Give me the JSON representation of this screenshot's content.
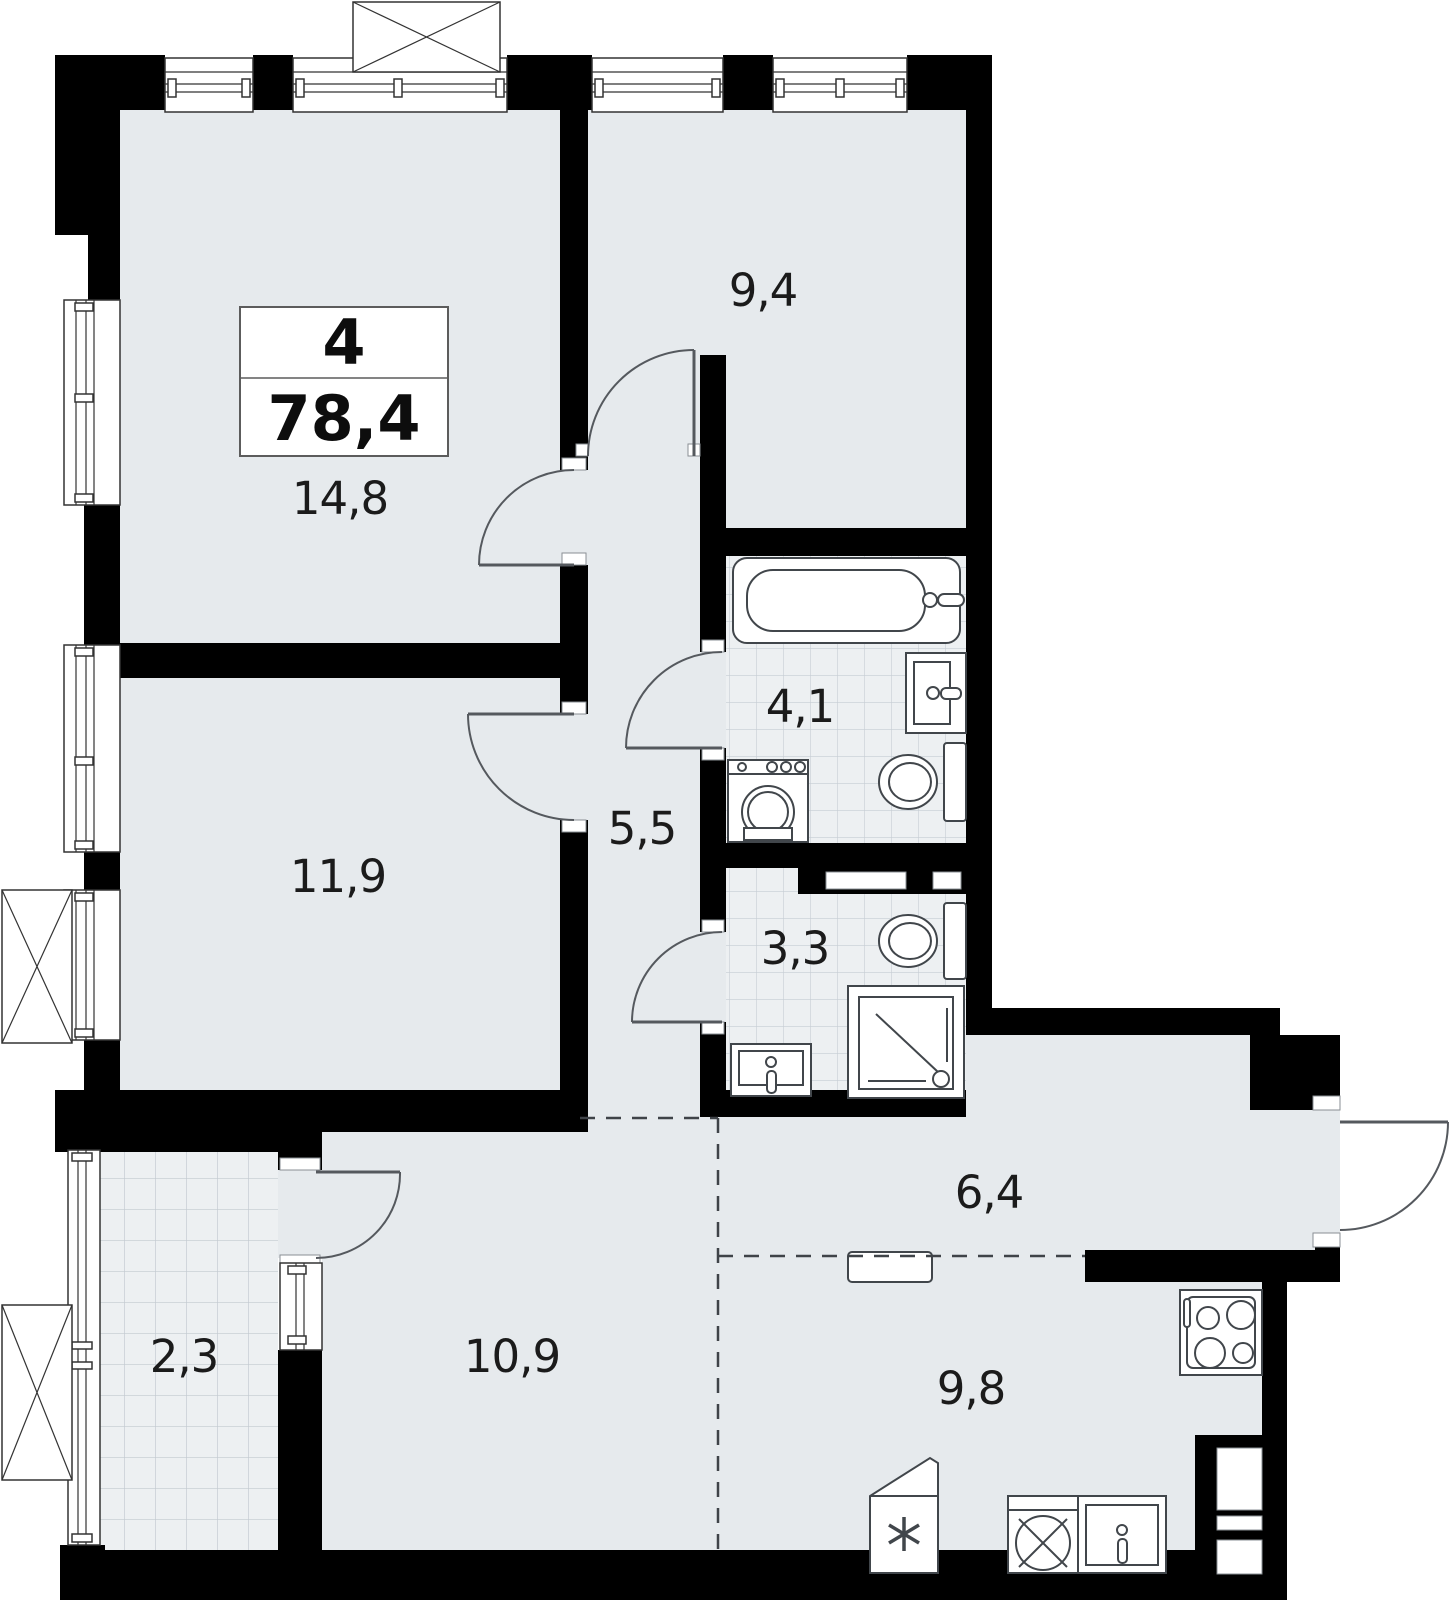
{
  "plan": {
    "summary": {
      "rooms_count": "4",
      "total_area": "78,4"
    },
    "rooms": [
      {
        "key": "room-14-8",
        "label": "14,8"
      },
      {
        "key": "room-9-4",
        "label": "9,4"
      },
      {
        "key": "room-11-9",
        "label": "11,9"
      },
      {
        "key": "hall-5-5",
        "label": "5,5"
      },
      {
        "key": "bath-4-1",
        "label": "4,1"
      },
      {
        "key": "wc-3-3",
        "label": "3,3"
      },
      {
        "key": "corridor-6-4",
        "label": "6,4"
      },
      {
        "key": "balcony-2-3",
        "label": "2,3"
      },
      {
        "key": "living-10-9",
        "label": "10,9"
      },
      {
        "key": "kitchen-9-8",
        "label": "9,8"
      }
    ],
    "colors": {
      "wall": "#000000",
      "floor": "#e6eaed",
      "tile_floor": "#edf0f2",
      "line": "#555555"
    }
  }
}
